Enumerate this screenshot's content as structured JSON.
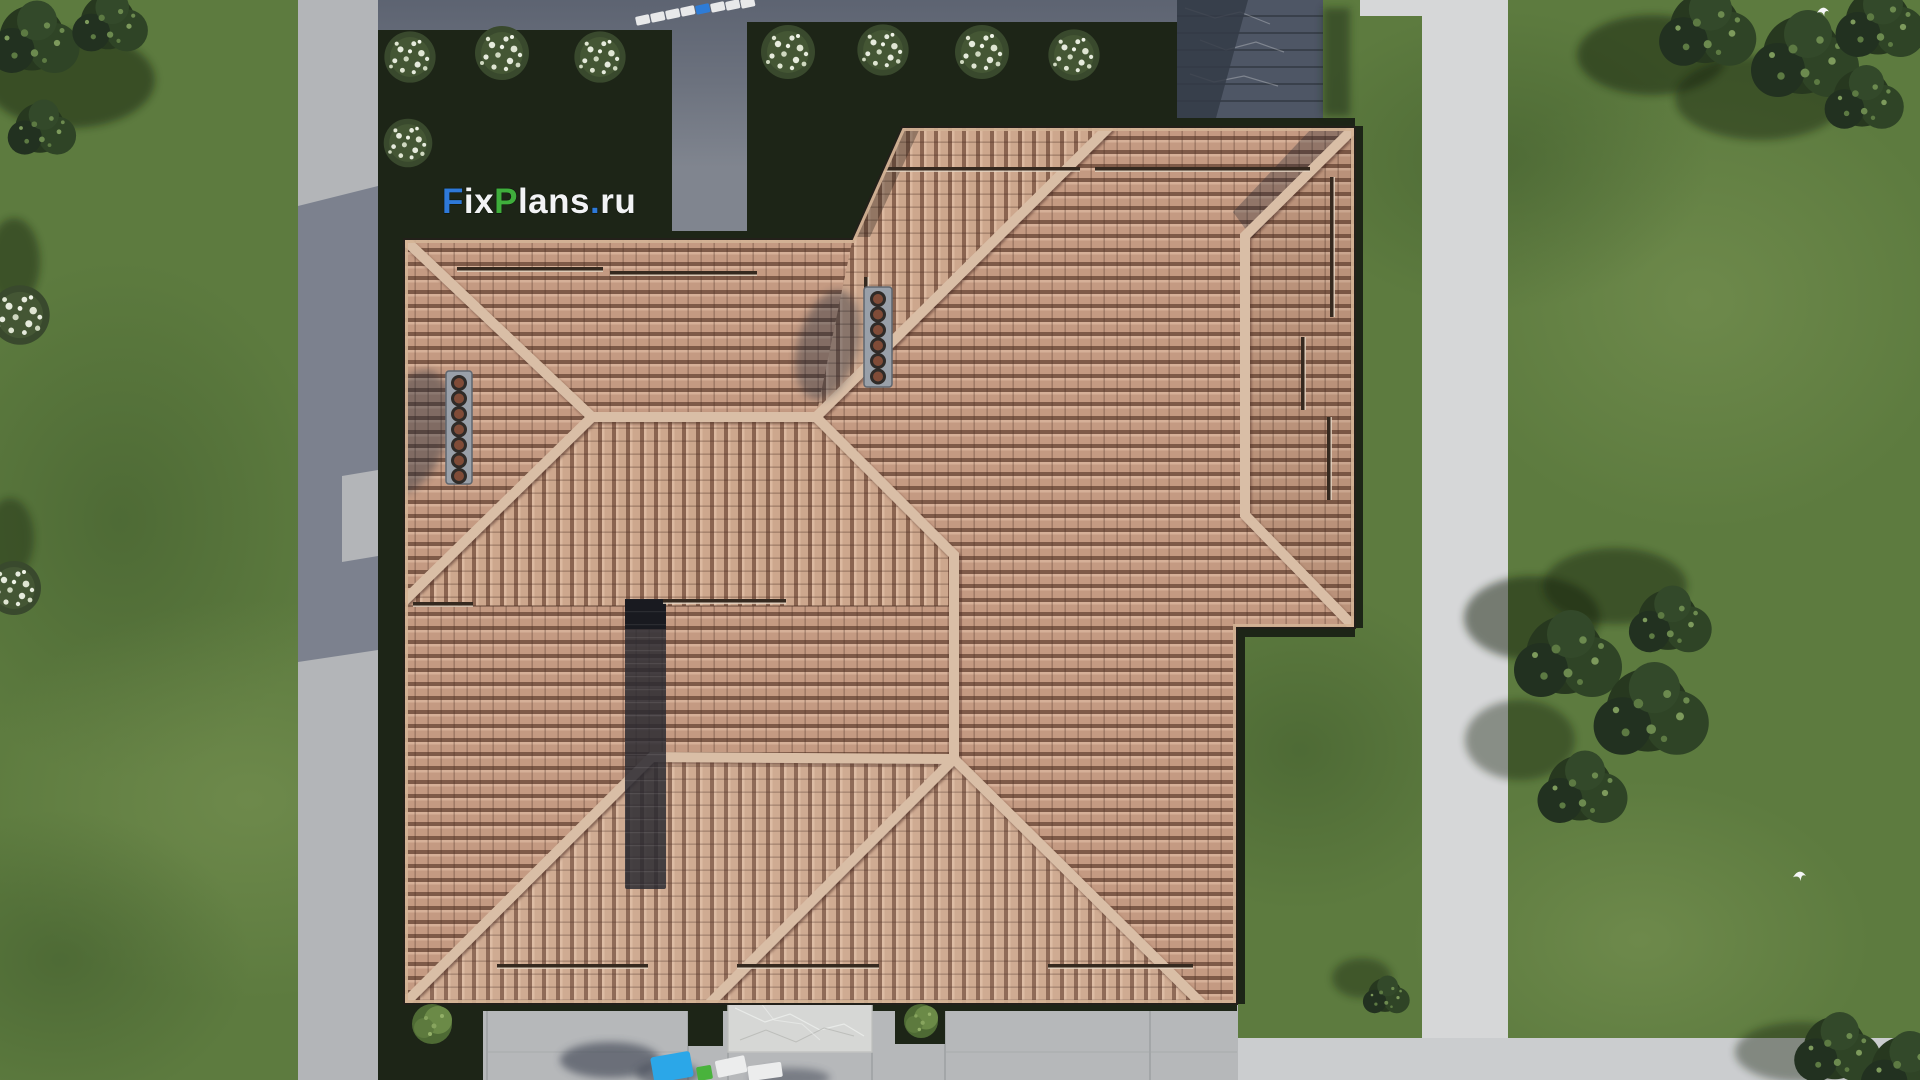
{
  "watermark": {
    "full": "FixPlans.ru",
    "f": "F",
    "ix": "ix",
    "p": "P",
    "lans": "lans",
    "dot": ".",
    "ru": "ru",
    "color_f": "#2e79d9",
    "color_p": "#3fae3c",
    "color_dot": "#2e79d9",
    "color_text": "#f2f3f5"
  },
  "palette": {
    "grass": "#5d7b3f",
    "grass_light": "#7b9555",
    "grass_dark": "#3f5a2c",
    "garden_bed": "#1d2517",
    "road_left": "#b3b5b8",
    "path_white": "#d6d7d8",
    "path_bottom": "#cbcdcf",
    "driveway": "#b6b8ba",
    "court_concrete": "#80858f",
    "roof_tile": "#c49a82",
    "roof_tile_shadow": "#7e5a48",
    "ridge_cap": "#d9bea6",
    "entrance_steps_stone": "#4e5665",
    "marble_slab": "#d6d7d5",
    "stepping_stone": "#e8e9ea",
    "stepping_stone_blue": "#2e7cd6",
    "vent_box": "#99a0a9",
    "vent_pot": "#804c38",
    "panel_strip": "#2a2a31",
    "tree_foliage": "#27381f",
    "flower_bush_dots": "#e6ebdd",
    "block_blue": "#2ba7e8",
    "block_green": "#49b33c"
  },
  "scene": {
    "view": "aerial top-down 3d render",
    "subject": "house hip roof with terracotta tiles, lawn, paths and trees",
    "chimney_vent_pots_left": 7,
    "chimney_vent_pots_right": 6,
    "stepping_stone_count": 8,
    "flower_bush_count_beds": 8,
    "bird_count": 2
  }
}
